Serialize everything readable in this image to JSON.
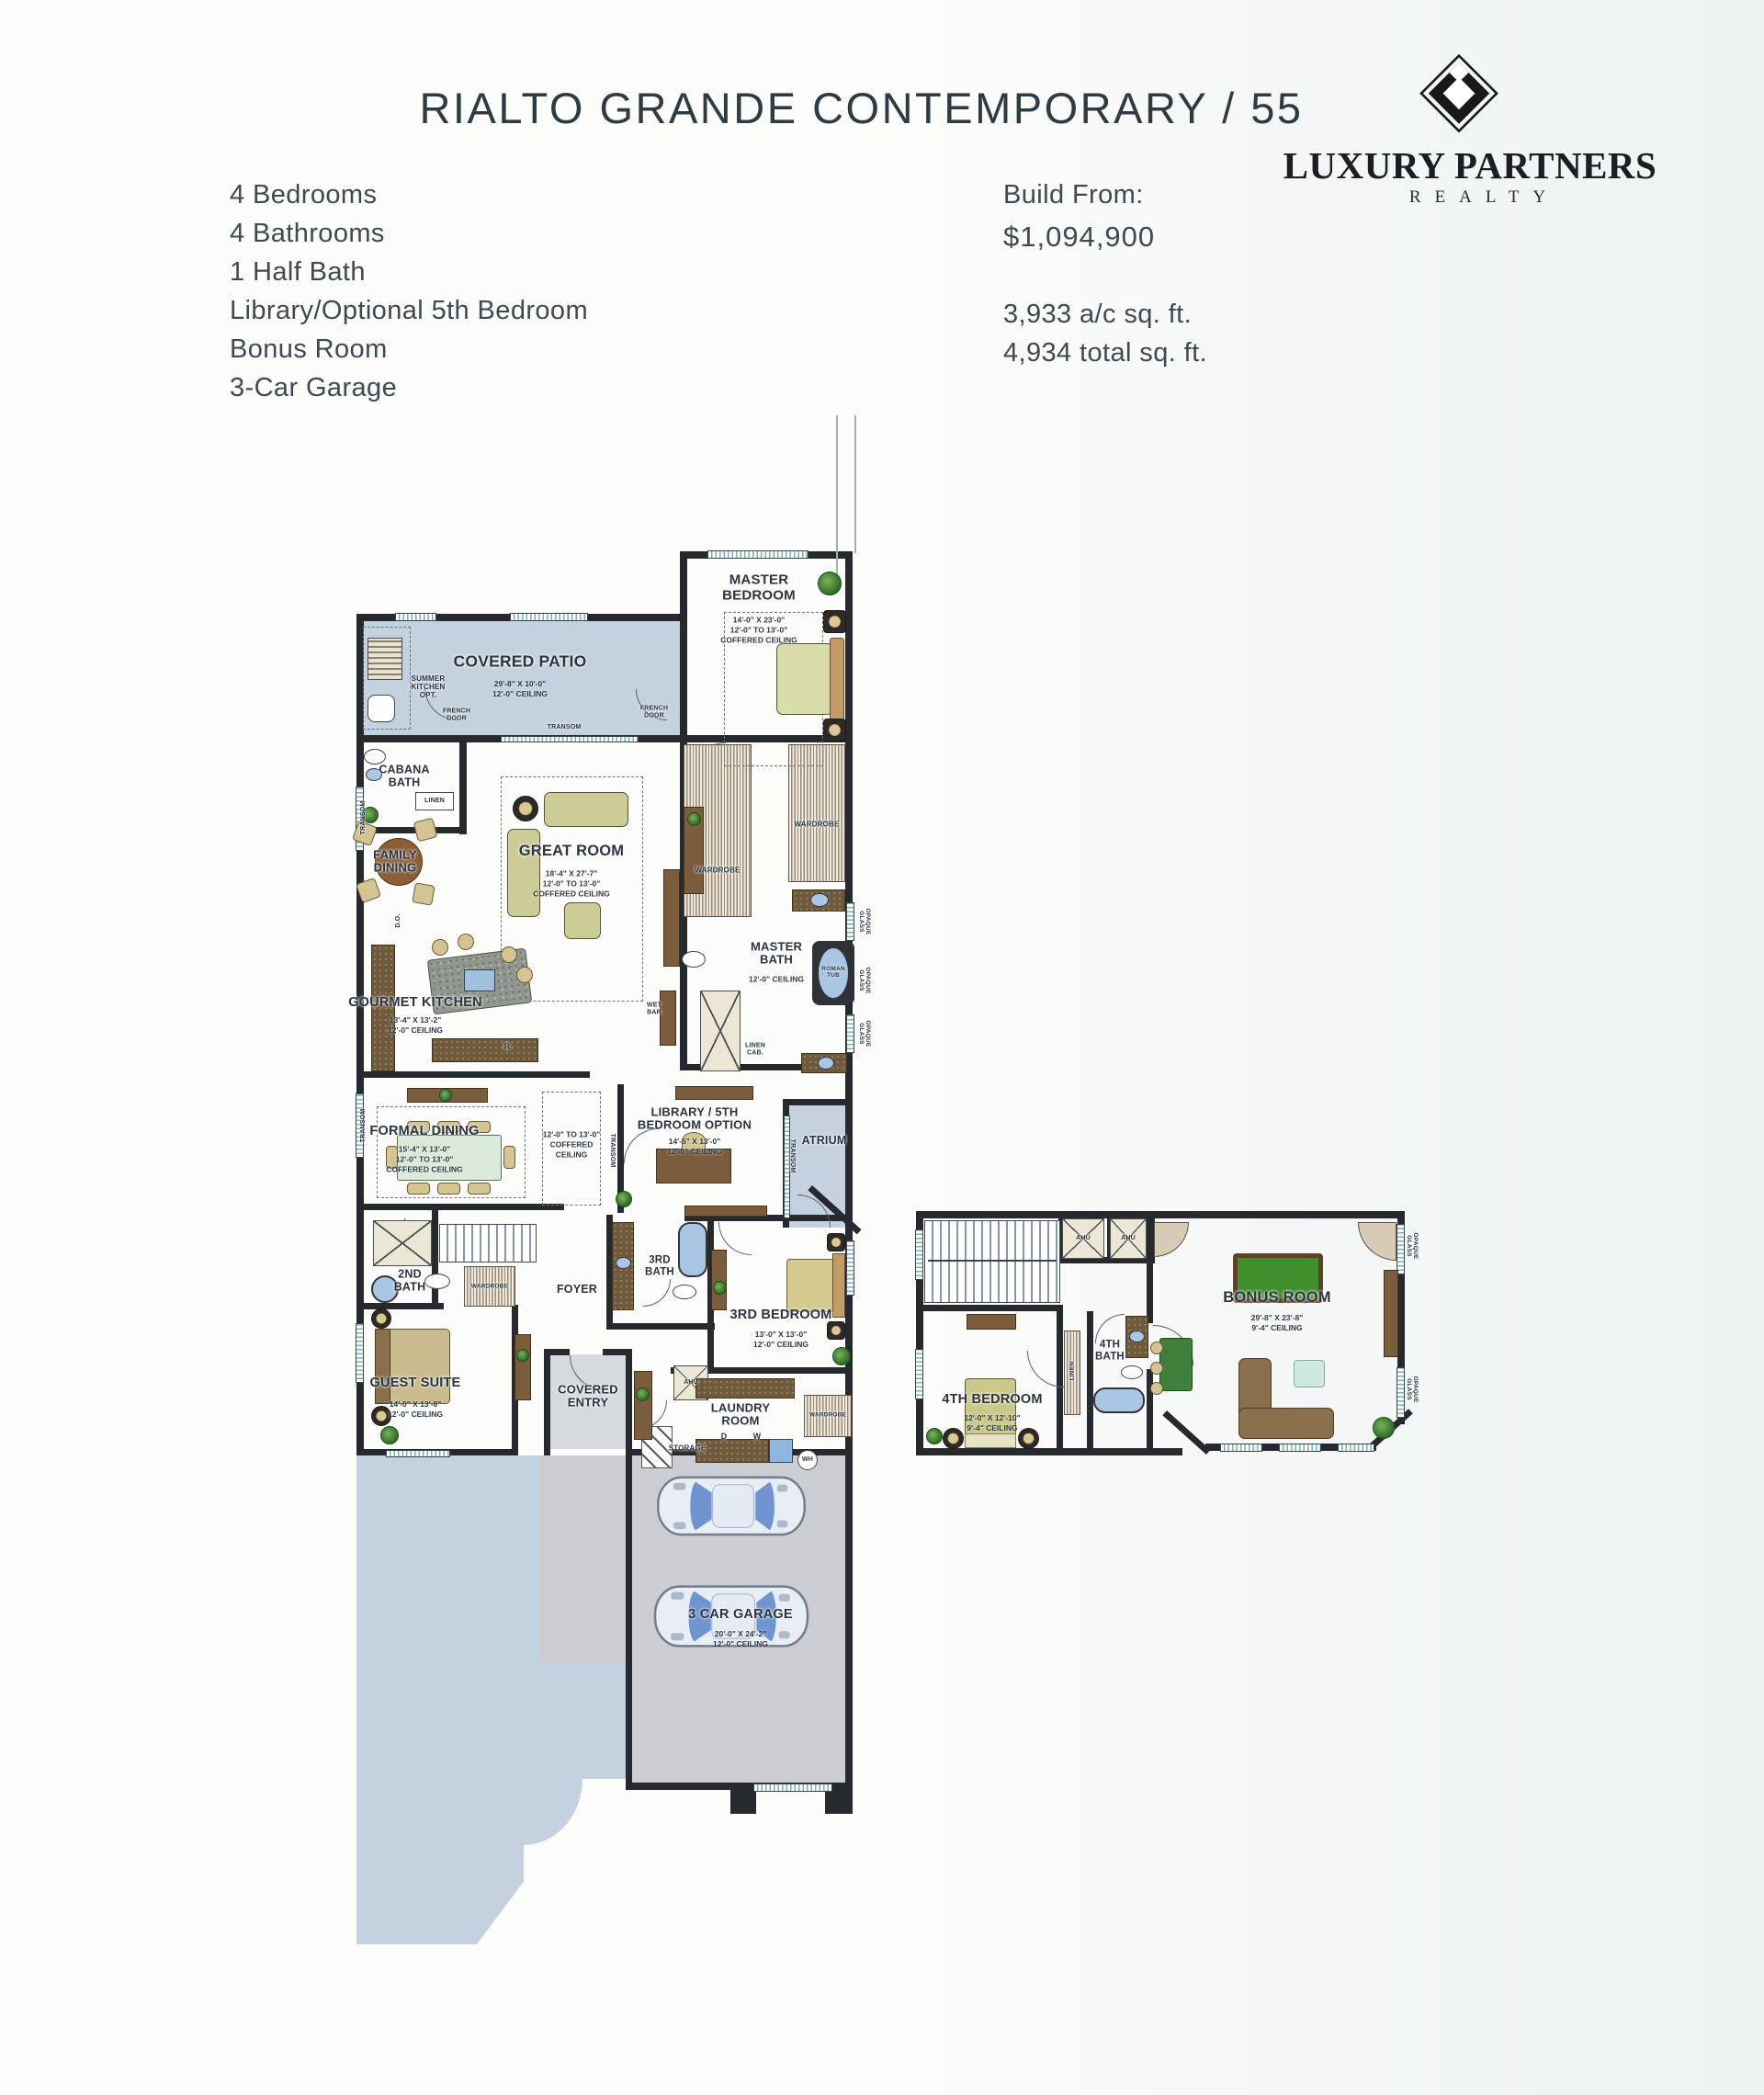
{
  "header": {
    "title": "RIALTO GRANDE CONTEMPORARY / 55"
  },
  "brand": {
    "name_primary": "LUXURY PARTNERS",
    "name_sub": "REALTY",
    "mark": "diamond-lp-monogram"
  },
  "features": [
    "4 Bedrooms",
    "4 Bathrooms",
    "1 Half Bath",
    "Library/Optional 5th Bedroom",
    "Bonus Room",
    "3-Car Garage"
  ],
  "pricing": {
    "build_from_label": "Build From:",
    "price": "$1,094,900",
    "ac_area": "3,933 a/c sq. ft.",
    "total_area": "4,934 total sq. ft."
  },
  "floorplan": {
    "rooms": {
      "covered_patio": {
        "label": "COVERED PATIO",
        "dims": "29'-8\" X 10'-0\"\n12'-0\" CEILING"
      },
      "master_bedroom": {
        "label": "MASTER\nBEDROOM",
        "dims": "14'-0\" X 23'-0\"\n12'-0\" TO 13'-0\"\nCOFFERED CEILING"
      },
      "cabana_bath": {
        "label": "CABANA\nBATH"
      },
      "family_dining": {
        "label": "FAMILY\nDINING"
      },
      "great_room": {
        "label": "GREAT ROOM",
        "dims": "18'-4\" X 27'-7\"\n12'-0\" TO 13'-0\"\nCOFFERED CEILING"
      },
      "gourmet_kitchen": {
        "label": "GOURMET KITCHEN",
        "dims": "13'-4\" X 13'-2\"\n12'-0\" CEILING"
      },
      "master_bath": {
        "label": "MASTER\nBATH",
        "dims": "12'-0\" CEILING"
      },
      "wet_bar": {
        "label": "WET\nBAR"
      },
      "formal_dining": {
        "label": "FORMAL DINING",
        "dims": "15'-4\" X 13'-0\"\n12'-0\" TO 13'-0\"\nCOFFERED CEILING"
      },
      "gallery": {
        "dims": "12'-0\" TO 13'-0\"\nCOFFERED\nCEILING"
      },
      "library": {
        "label": "LIBRARY / 5TH\nBEDROOM OPTION",
        "dims": "14'-5\" X 13'-0\"\n12'-0\" CEILING"
      },
      "atrium": {
        "label": "ATRIUM"
      },
      "second_bath": {
        "label": "2ND\nBATH"
      },
      "guest_suite": {
        "label": "GUEST SUITE",
        "dims": "14'-0\" X 13'-8\"\n12'-0\" CEILING"
      },
      "foyer": {
        "label": "FOYER"
      },
      "covered_entry": {
        "label": "COVERED\nENTRY"
      },
      "third_bath": {
        "label": "3RD\nBATH"
      },
      "third_bedroom": {
        "label": "3RD BEDROOM",
        "dims": "13'-0\" X 13'-0\"\n12'-0\" CEILING"
      },
      "laundry_room": {
        "label": "LAUNDRY\nROOM"
      },
      "storage": {
        "label": "STORAGE"
      },
      "garage": {
        "label": "3 CAR GARAGE",
        "dims": "20'-0\" X 24'-2\"\n12'-0\" CEILING"
      },
      "fourth_bedroom": {
        "label": "4TH BEDROOM",
        "dims": "12'-0\" X 12'-10\"\n9'-4\" CEILING"
      },
      "fourth_bath": {
        "label": "4TH\nBATH"
      },
      "bonus_room": {
        "label": "BONUS ROOM",
        "dims": "29'-8\" X 23'-8\"\n9'-4\" CEILING"
      }
    },
    "tags": {
      "summer_kitchen": "SUMMER\nKITCHEN\nOPT.",
      "french_door": "FRENCH\nDOOR",
      "transom": "TRANSOM",
      "linen": "LINEN",
      "linen_cab": "LINEN\nCAB.",
      "wardrobe": "WARDROBE",
      "opaque_glass": "OPAQUE\nGLASS",
      "roman_tub": "ROMAN\nTUB",
      "ahu": "AHU",
      "wh": "WH",
      "washer": "W",
      "dryer": "D",
      "range": "R",
      "door_opening": "D.O."
    },
    "colors": {
      "walls": "#26292d",
      "patio_blue": "#c4d1df",
      "garage_gray": "#cbcdd3",
      "label_ink": "#2b3440"
    }
  }
}
